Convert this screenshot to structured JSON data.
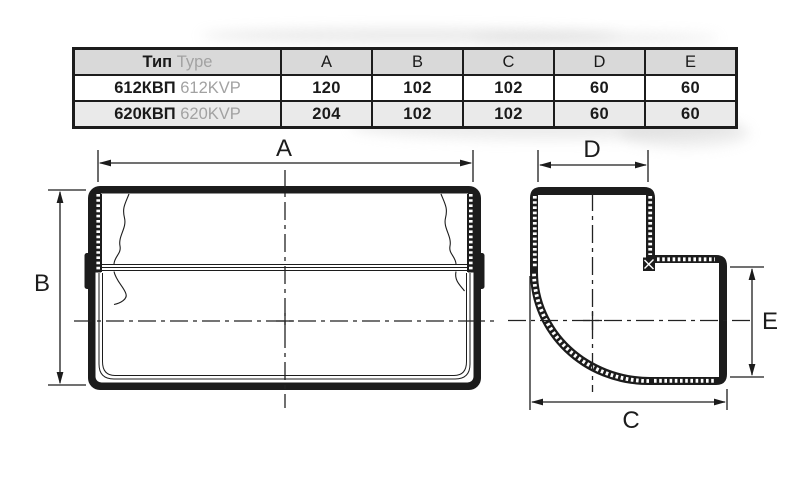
{
  "table": {
    "type_header": {
      "ru": "Тип",
      "en": "Type"
    },
    "dim_columns": [
      "A",
      "B",
      "C",
      "D",
      "E"
    ],
    "rows": [
      {
        "model_ru": "612КВП",
        "model_en": "612KVP",
        "A": "120",
        "B": "102",
        "C": "102",
        "D": "60",
        "E": "60"
      },
      {
        "model_ru": "620КВП",
        "model_en": "620KVP",
        "A": "204",
        "B": "102",
        "C": "102",
        "D": "60",
        "E": "60"
      }
    ]
  },
  "drawing": {
    "front_view": {
      "width_label": "A",
      "height_label": "B"
    },
    "elbow_view": {
      "top_label": "D",
      "right_label": "E",
      "bottom_label": "C"
    }
  },
  "colors": {
    "line": "#1c1c1c",
    "table_header_bg": "#d9d9d9",
    "table_alt_row_bg": "#eaeaea",
    "muted_text": "#a2a2a2"
  }
}
